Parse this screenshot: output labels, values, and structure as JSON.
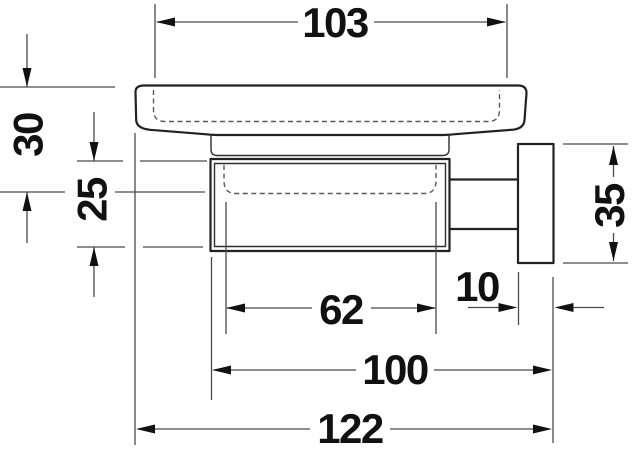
{
  "drawing": {
    "dimensions": {
      "dish_top_width": "103",
      "dish_front_height": "30",
      "holder_front_height": "25",
      "wall_plate_height": "35",
      "holder_inner_depth": "62",
      "wall_plate_thickness": "10",
      "depth_excluding_plate": "100",
      "overall_depth": "122"
    },
    "colors": {
      "outline": "#222222",
      "dimension_lines": "#4a4a4a",
      "hidden_edges_dashed": "#5a5a5a",
      "text": "#111111",
      "background": "#ffffff"
    }
  }
}
